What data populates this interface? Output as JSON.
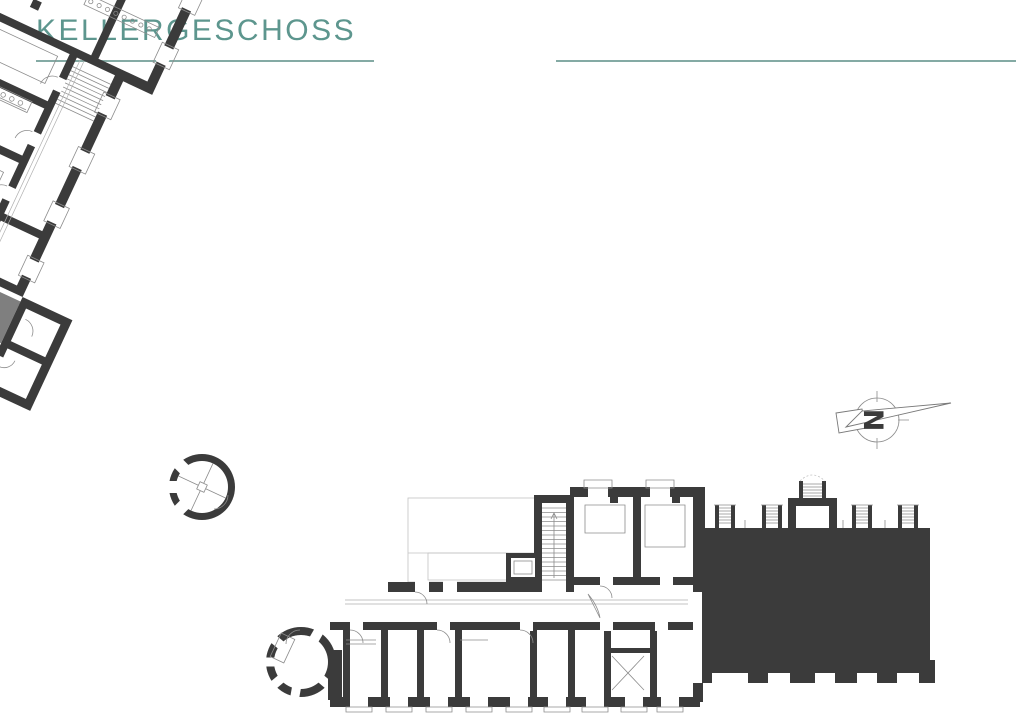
{
  "header": {
    "title": "KELLERGESCHOSS"
  },
  "north_arrow": {
    "label": "N",
    "points": "east-right"
  },
  "colors": {
    "title_text": "#5d968e",
    "title_underline": "#84aaa4",
    "wall": "#3b3b3b",
    "secondary_room_fill": "#7f7f7f",
    "background": "#ffffff"
  }
}
